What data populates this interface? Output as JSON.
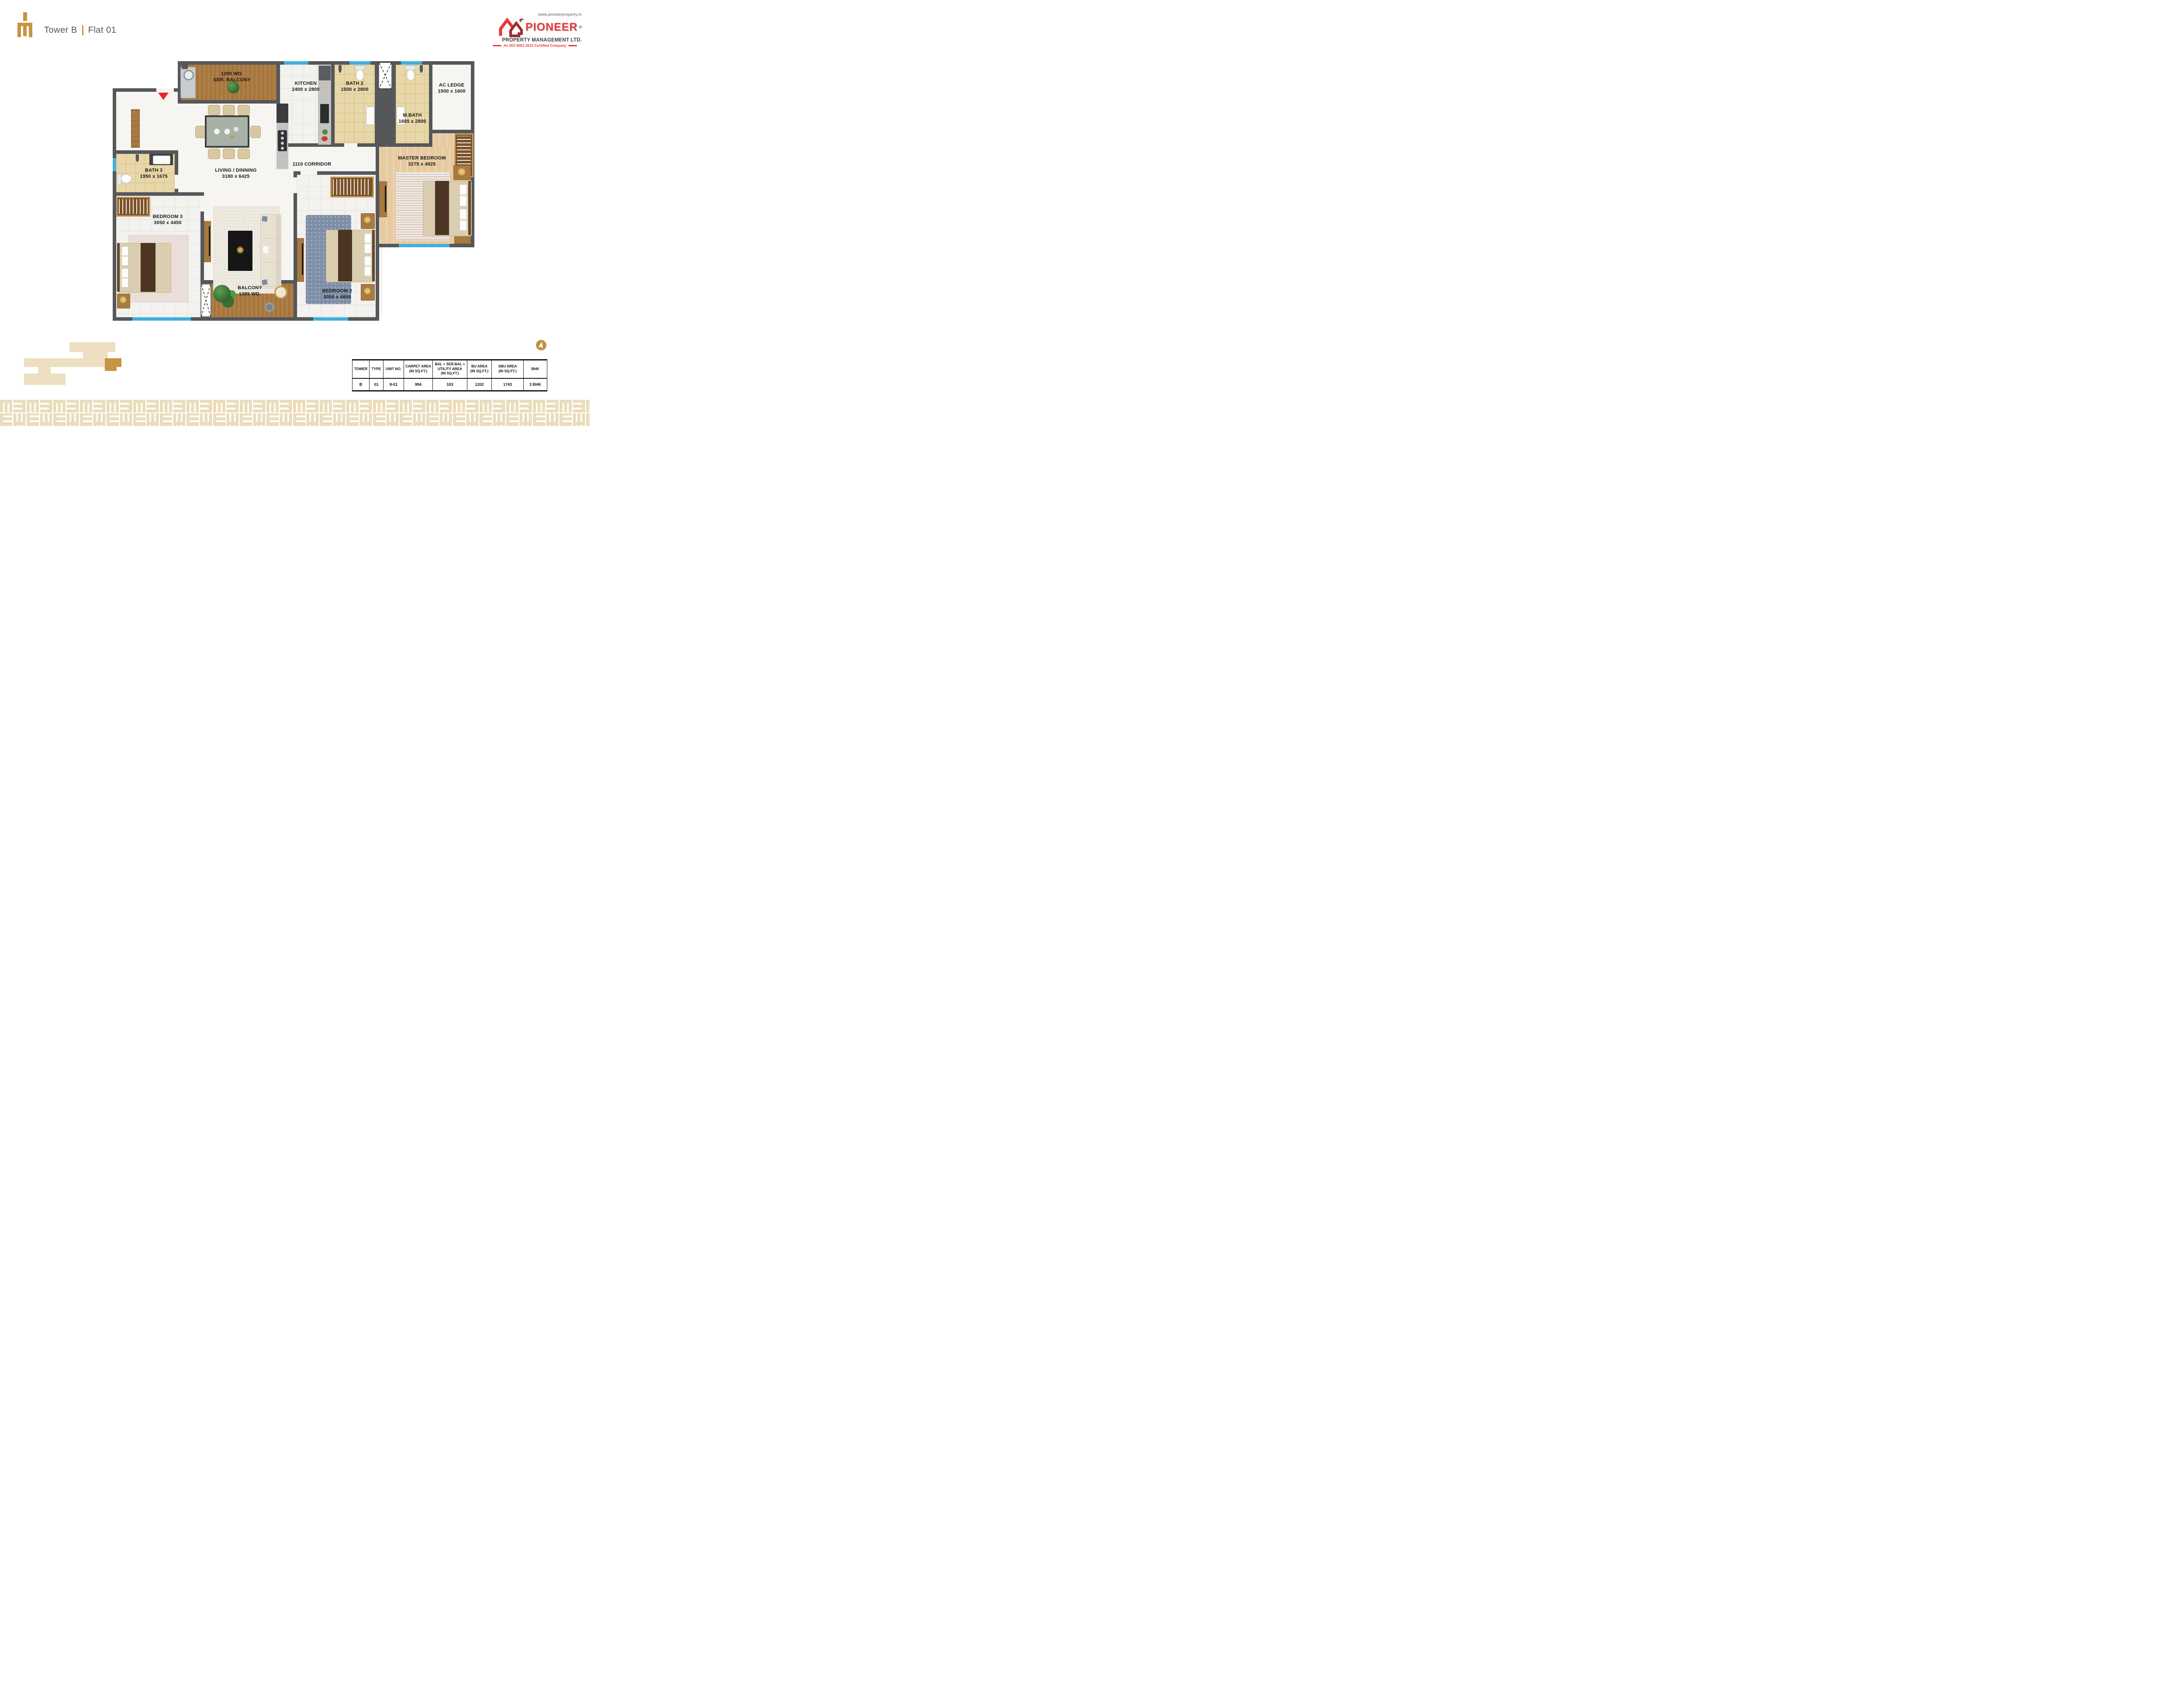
{
  "header": {
    "tower_label": "Tower B",
    "separator": "|",
    "flat_label": "Flat 01"
  },
  "brand": {
    "website": "www.pioneerproperty.in",
    "name": "PIONEER",
    "registered_mark": "®",
    "subtitle": "PROPERTY MANAGEMENT LTD.",
    "iso_line": "An ISO 9001:2015 Certified Company"
  },
  "floor_plan": {
    "entry_marker": "entrance-arrow",
    "rooms": [
      {
        "id": "ser-balcony",
        "line1": "1200 WD.",
        "line2": "SER. BALCONY"
      },
      {
        "id": "kitchen",
        "line1": "KITCHEN",
        "line2": "2400 x 2800"
      },
      {
        "id": "bath-2",
        "line1": "BATH 2",
        "line2": "1500 x 2800"
      },
      {
        "id": "ac-ledge",
        "line1": "AC LEDGE",
        "line2": "1500 x 1600"
      },
      {
        "id": "m-bath",
        "line1": "M.BATH",
        "line2": "1665 x 2800"
      },
      {
        "id": "master-bedroom",
        "line1": "MASTER BEDROOM",
        "line2": "3275 x 4825"
      },
      {
        "id": "corridor",
        "line1": "1110  CORRIDOR",
        "line2": ""
      },
      {
        "id": "living-dining",
        "line1": "LIVING / DINNING",
        "line2": "3180 x 6425"
      },
      {
        "id": "bath-3",
        "line1": "BATH 3",
        "line2": "1950 x 1675"
      },
      {
        "id": "bedroom-3",
        "line1": "BEDROOM 3",
        "line2": "3050 x 4450"
      },
      {
        "id": "balcony",
        "line1": "BALCONY",
        "line2": "1385 WD."
      },
      {
        "id": "bedroom-2",
        "line1": "BEDROOM 2",
        "line2": "3050 x 4850"
      }
    ]
  },
  "area_table": {
    "headers": [
      "TOWER",
      "TYPE",
      "UNIT NO.",
      "CARPET AREA\n(IN SQ.FT.)",
      "BAL + SER.BAL +\nUTILITY AREA\n(IN SQ.FT.)",
      "BU AREA\n(IN SQ.FT.)",
      "SBU AREA\n(IN SQ.FT.)",
      "BHK"
    ],
    "row": [
      "B",
      "01",
      "8-01",
      "994",
      "103",
      "1202",
      "1743",
      "3 BHK"
    ]
  },
  "colors": {
    "brand_gold": "#C7953E",
    "brand_red": "#E8373D",
    "wall_gray": "#55575A",
    "window_blue": "#38ABE0",
    "pattern_beige": "#EBDCBB",
    "keyplan_beige": "#EDDFC1",
    "keyplan_highlight": "#C6953F"
  }
}
